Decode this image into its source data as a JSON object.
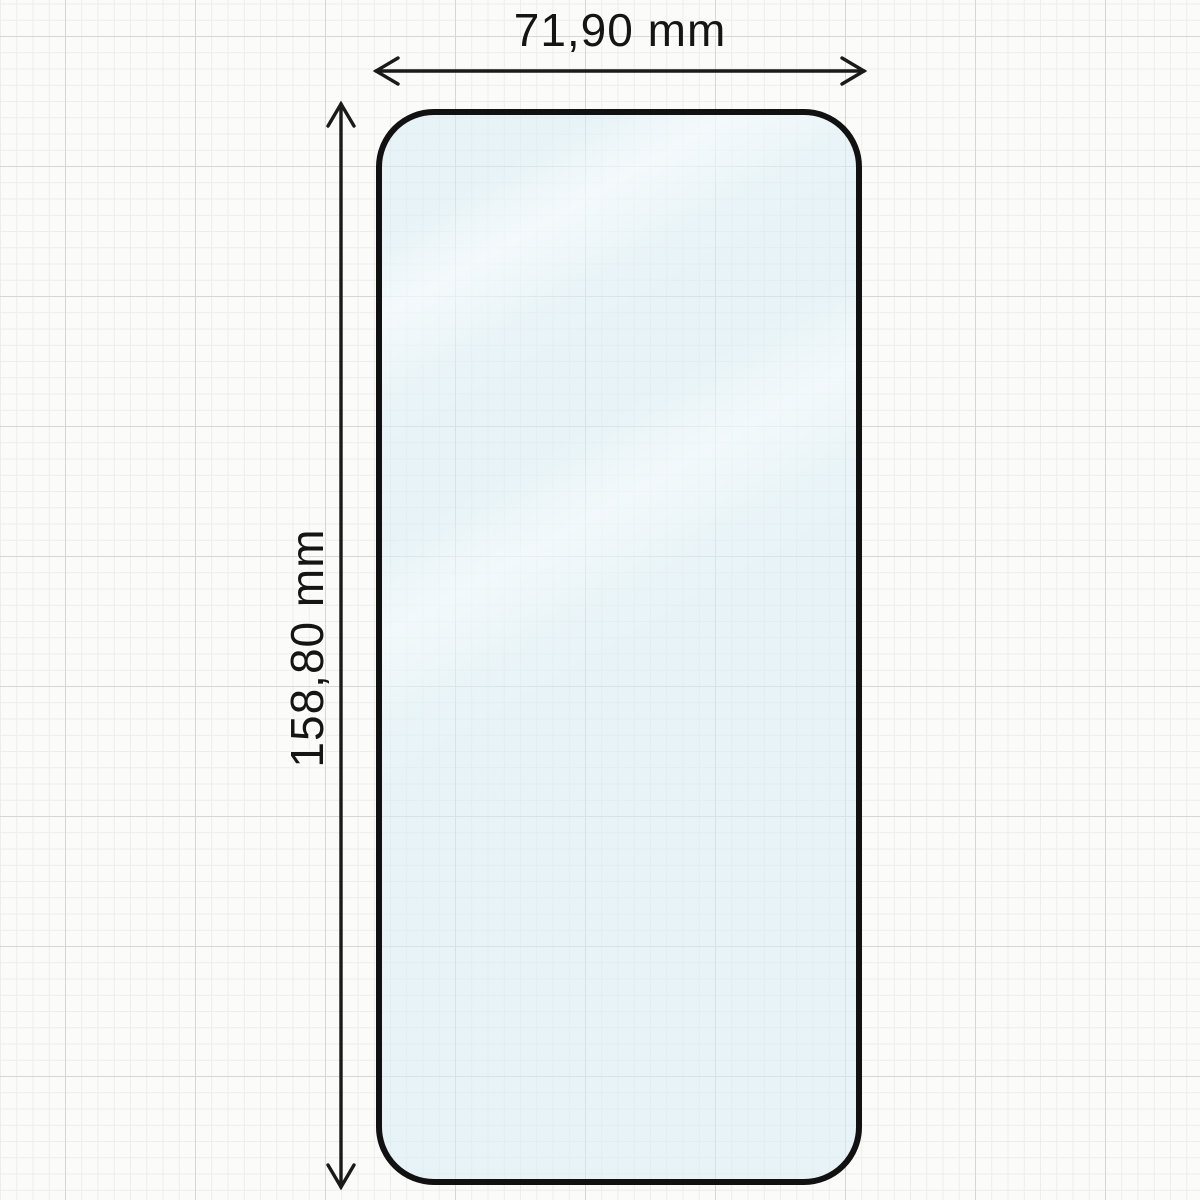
{
  "diagram": {
    "subject": "tempered-glass-screen-protector",
    "dimensions": {
      "width_label": "71,90 mm",
      "height_label": "158,80 mm"
    },
    "colors": {
      "background_paper": "#fbfbfa",
      "grid_minor": "#ededec",
      "grid_major": "#d6d6d6",
      "glass_outline": "#111111",
      "glass_tint": "#e9f3f7",
      "dimension_line": "#1a1a1a",
      "label_text": "#151515"
    }
  }
}
